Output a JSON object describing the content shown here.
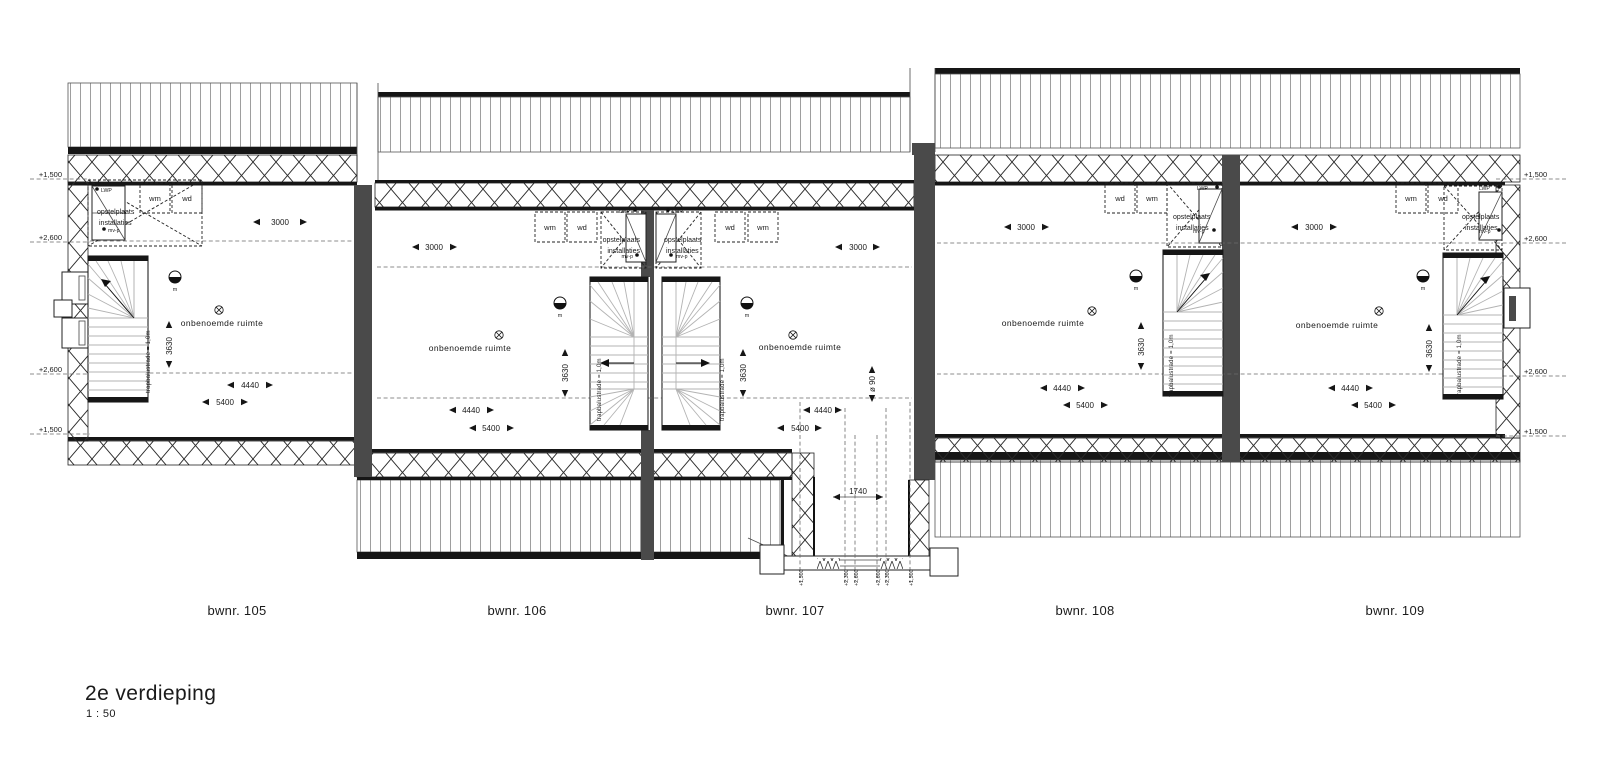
{
  "drawing": {
    "title": "2e verdieping",
    "scale": "1 : 50"
  },
  "units": [
    {
      "label": "bwnr. 105"
    },
    {
      "label": "bwnr. 106"
    },
    {
      "label": "bwnr. 107"
    },
    {
      "label": "bwnr. 108"
    },
    {
      "label": "bwnr. 109"
    }
  ],
  "rooms": {
    "unnamed": "onbenoemde ruimte"
  },
  "stairs": {
    "balustrade_note": "trapbalustrade = 1,0m"
  },
  "appliances": {
    "wm": "wm",
    "wd": "wd"
  },
  "installations": {
    "line1": "opstelplaats",
    "line2": "installaties",
    "lwp": "LWP",
    "mvp": "mv-p",
    "meter": "m"
  },
  "dimensions": {
    "d3000": "3000",
    "d3630": "3630",
    "d4440": "4440",
    "d5400": "5400",
    "d1740": "1740",
    "d90": "ø 90"
  },
  "levels": {
    "l1500": "+1,500",
    "l2300": "+2,300",
    "l2600": "+2,600"
  },
  "colors": {
    "line": "#1a1a1a",
    "wall": "#4a4a4a",
    "hatch": "#9e9e9e",
    "background": "#ffffff"
  }
}
